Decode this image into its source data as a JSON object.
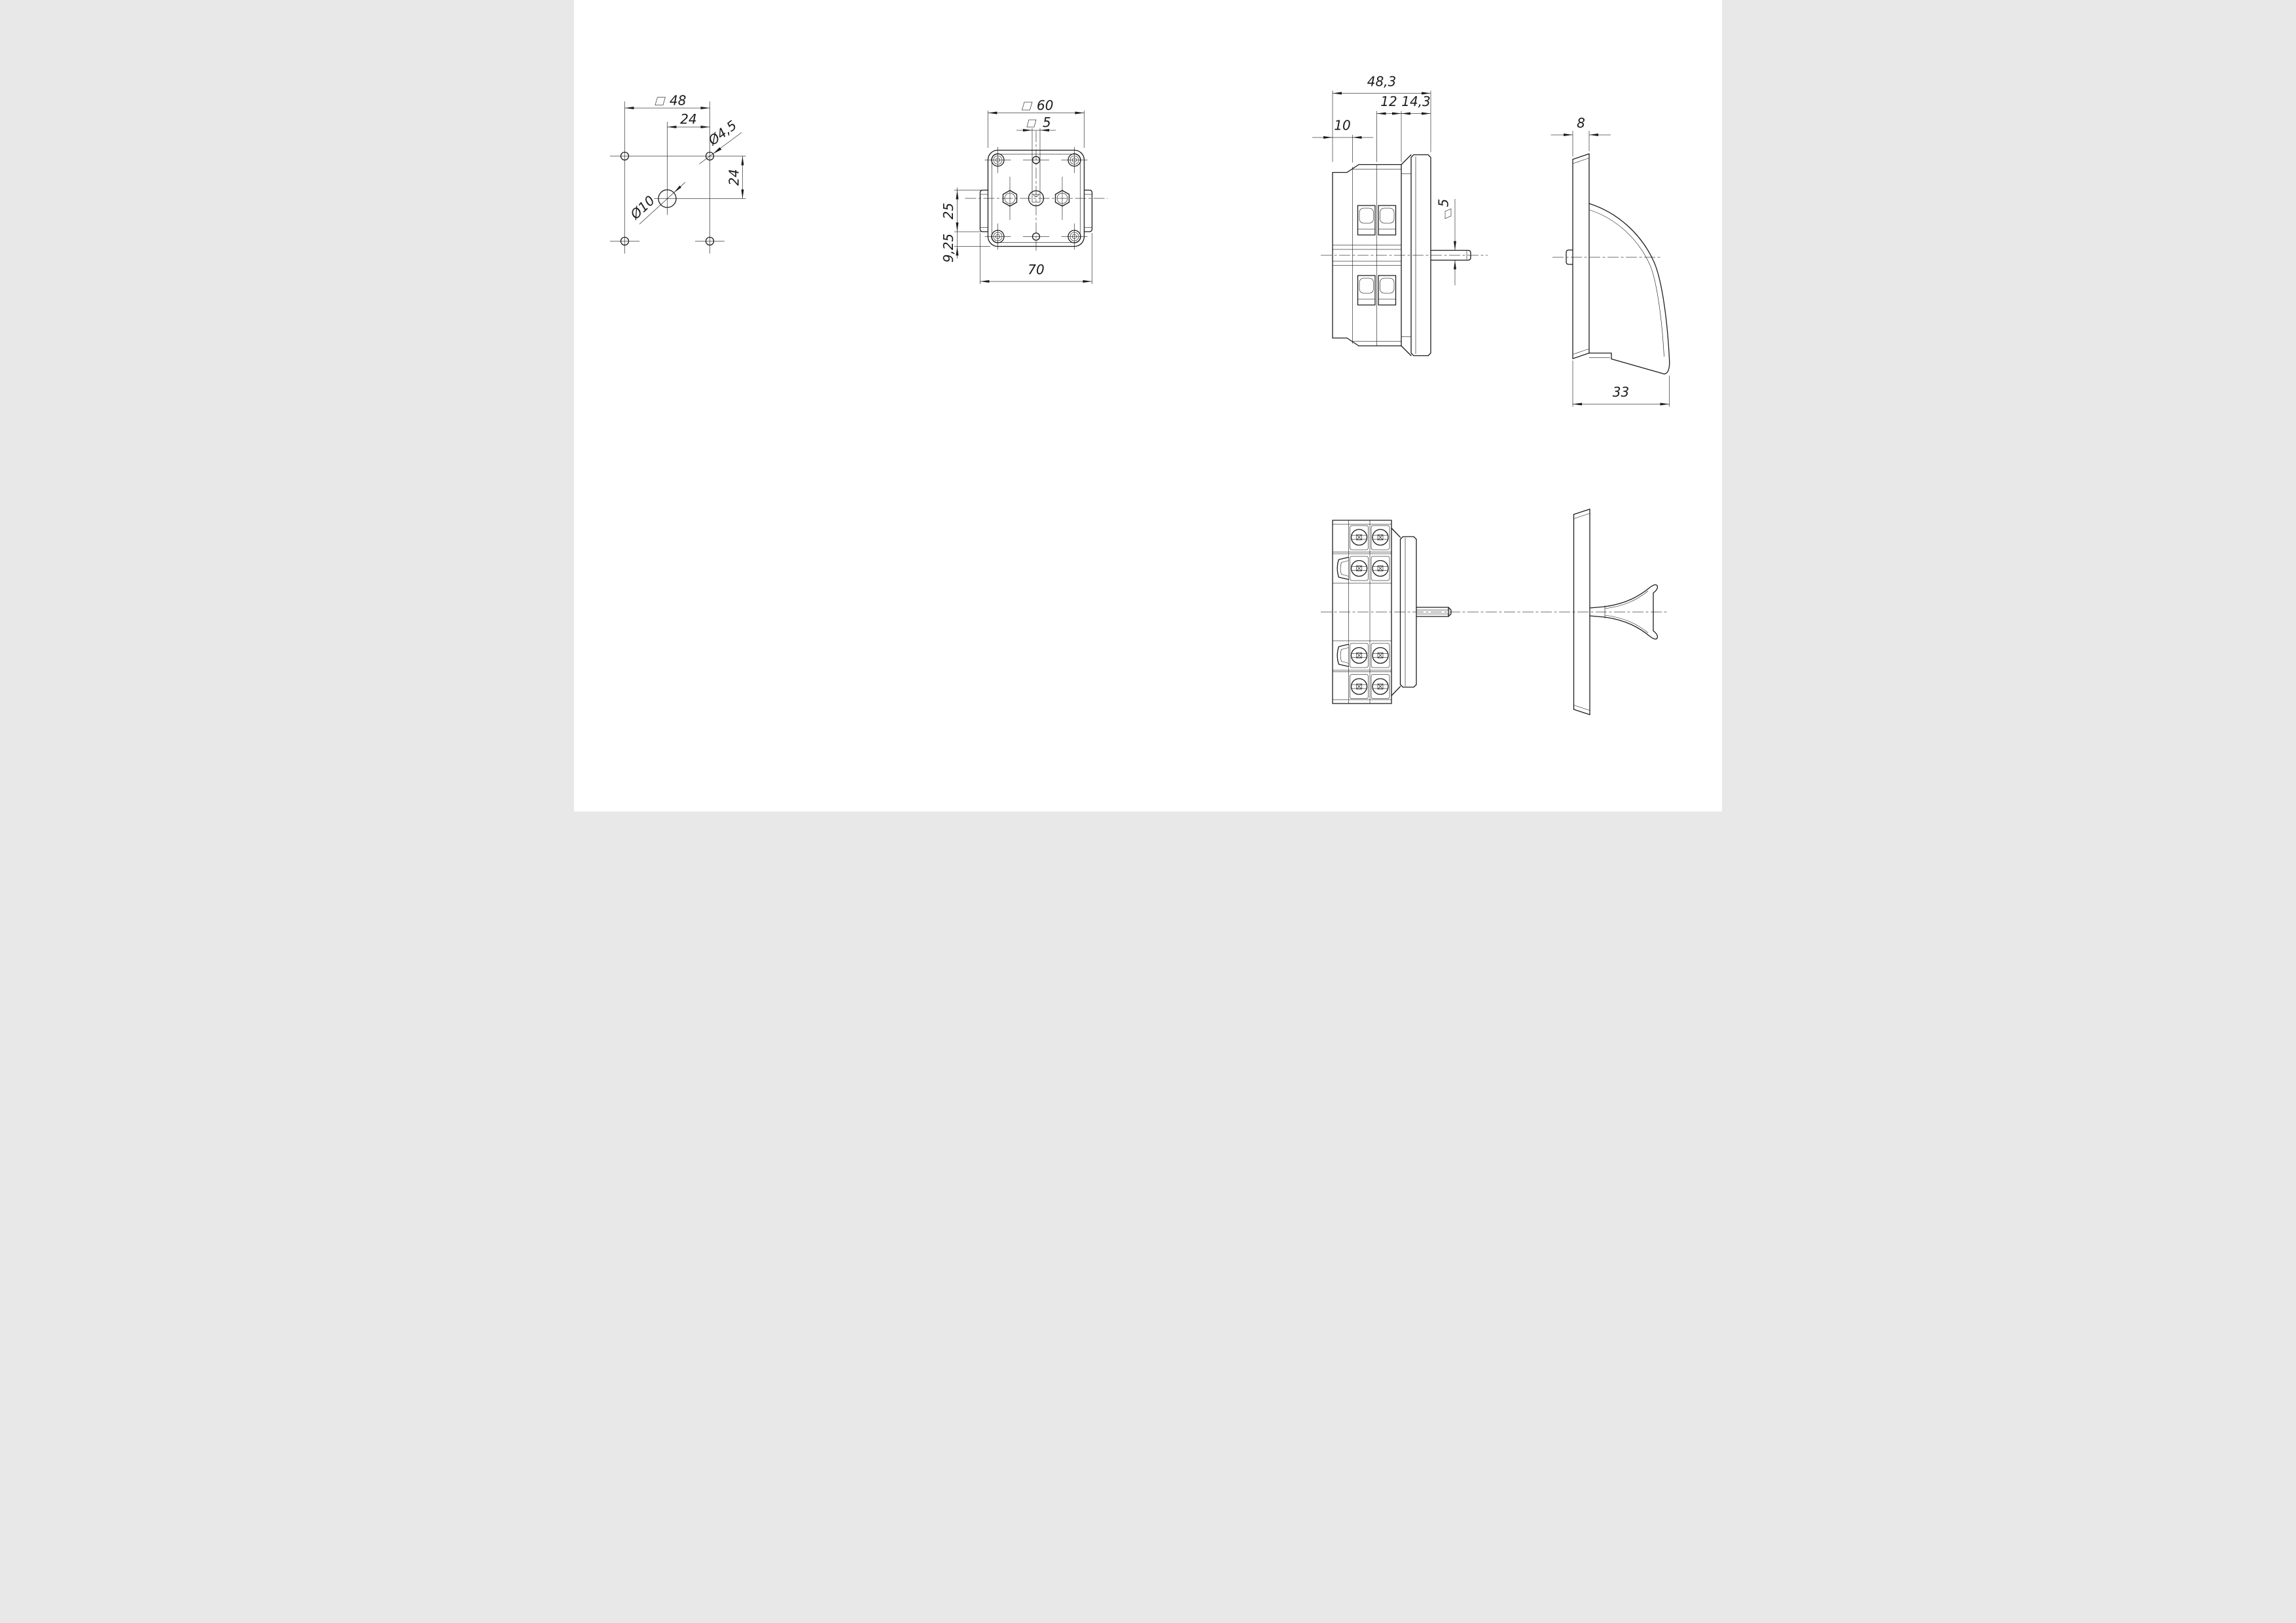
{
  "drawing": {
    "sheet": {
      "background": "#ffffff",
      "line_color": "#1c1c1c"
    },
    "symbols": {
      "square": "□",
      "diameter": "Ø"
    },
    "views": {
      "mounting_pattern": {
        "title": "mounting-hole-pattern",
        "dims": {
          "width_square": "48",
          "offset_h": "24",
          "offset_v": "24",
          "hole_small": "Ø4,5",
          "hole_center": "Ø10"
        }
      },
      "front_view": {
        "title": "front-view",
        "dims": {
          "body_square": "60",
          "shaft_square": "5",
          "flange_offset": "25",
          "flange_edge": "9,25",
          "overall_width": "70"
        }
      },
      "side_view": {
        "title": "side-view",
        "dims": {
          "overall_depth": "48,3",
          "mid_section": "12",
          "front_section": "14,3",
          "rear_section": "10",
          "shaft_square": "5"
        }
      },
      "handle_view": {
        "title": "handle-side-view",
        "dims": {
          "plate_thickness": "8",
          "handle_length": "33"
        }
      },
      "bottom_view": {
        "title": "bottom-assembly-view",
        "dims": {}
      }
    }
  }
}
